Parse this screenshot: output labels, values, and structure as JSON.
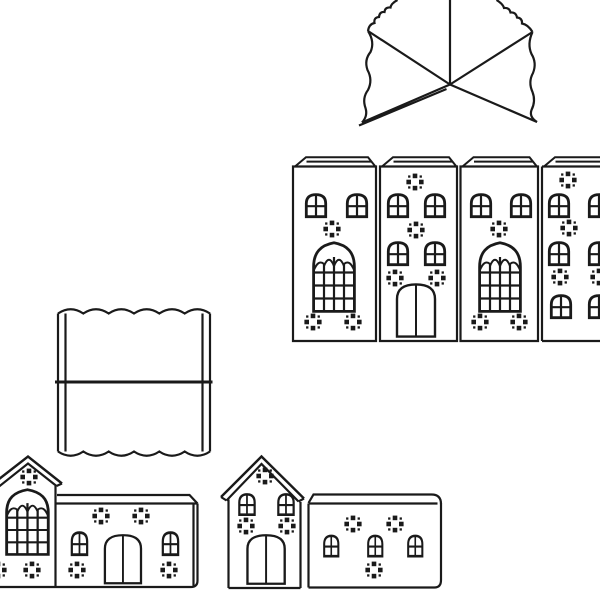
{
  "canvas": {
    "width": 600,
    "height": 600,
    "background": "#ffffff",
    "line_color": "#1a1a1a"
  },
  "diagram": {
    "type": "papercraft-template",
    "subject": "black-and-white cut-out template pieces for a paper house / church model",
    "text_content": "none — the image contains only line art, no visible text",
    "pieces": [
      {
        "id": "tower-roof",
        "label": "Cross-gable tower roof panel with scalloped shingle edges and diagonal fold lines radiating from a centre point, cut off at the top edge"
      },
      {
        "id": "tower-wall-strip",
        "label": "Horizontal strip of four tower wall panels, each with a bevelled roof tab on top",
        "panels": [
          {
            "label": "Panel 1: two arched windows, diamond dot ornament, large gothic tracery window, two dot ornaments"
          },
          {
            "label": "Panel 2: dot ornament, two arched windows, dot ornament, two arched windows, two dot ornaments, arched double door"
          },
          {
            "label": "Panel 3: two arched windows, diamond dot ornament, large gothic tracery window, two dot ornaments"
          },
          {
            "label": "Panel 4: dot ornaments and three rows of paired arched windows, cut off at the right edge"
          }
        ]
      },
      {
        "id": "nave-roof",
        "label": "Rectangular roof panel with scalloped front and back eaves, narrow side glue flaps and a centre ridge fold line"
      },
      {
        "id": "left-assembly",
        "label": "Gable end with gothic tracery window (cut off at left edge) joined to a long side wall with two arched windows and an arched double door"
      },
      {
        "id": "front-gable",
        "label": "Gable-front house piece with dot ornament, two arched windows, two dot ornaments and an arched double door"
      },
      {
        "id": "right-side-wall",
        "label": "Long side wall piece with rounded roof strip, three arched windows and three dot ornaments"
      }
    ]
  }
}
